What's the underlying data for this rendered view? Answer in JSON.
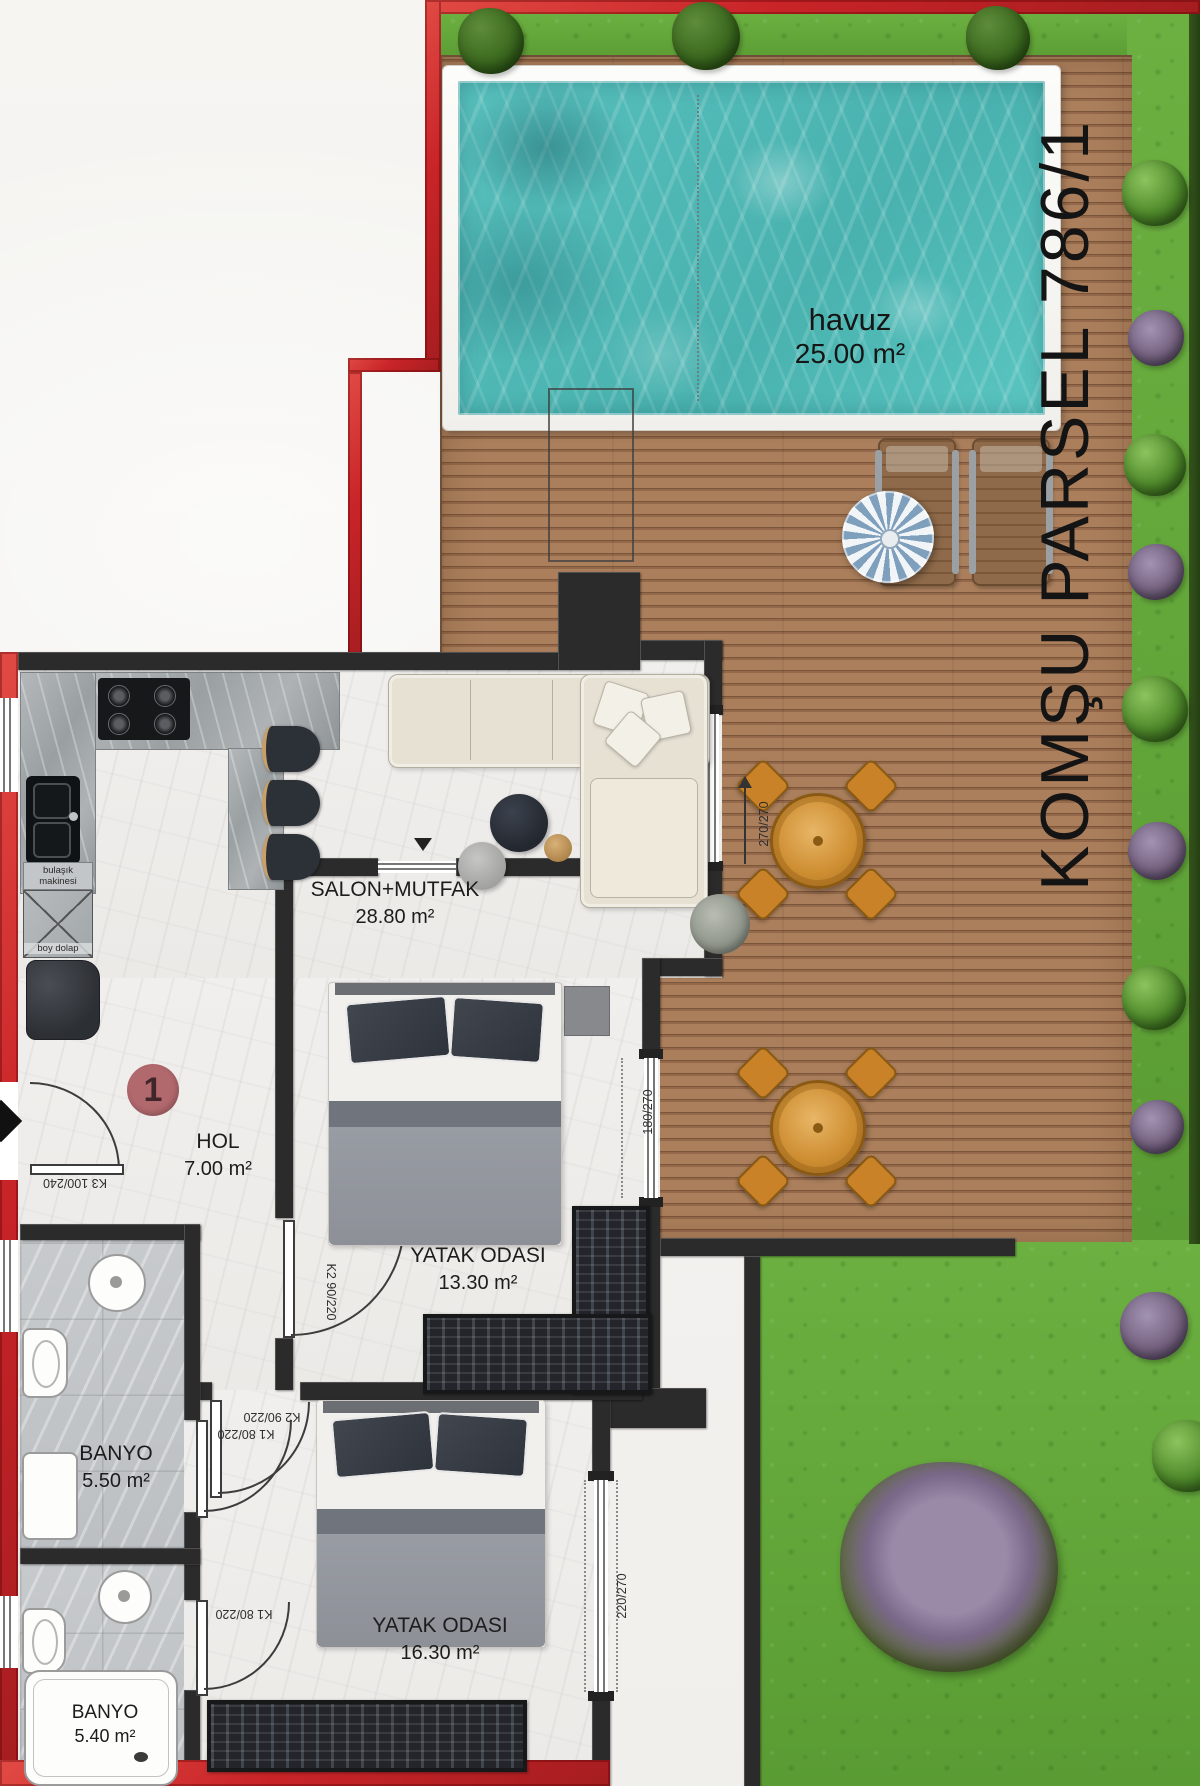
{
  "outdoor": {
    "pool": {
      "name": "havuz",
      "area": "25.00 m²"
    },
    "neighbor_parcel_label": "KOMŞU PARSEL 786/1"
  },
  "unit": {
    "number": "1"
  },
  "rooms": [
    {
      "id": "salon",
      "name": "SALON+MUTFAK",
      "area": "28.80 m²"
    },
    {
      "id": "hol",
      "name": "HOL",
      "area": "7.00 m²"
    },
    {
      "id": "bedroom1",
      "name": "YATAK ODASI",
      "area": "13.30 m²"
    },
    {
      "id": "bathroom1",
      "name": "BANYO",
      "area": "5.50 m²"
    },
    {
      "id": "bedroom2",
      "name": "YATAK ODASI",
      "area": "16.30 m²"
    },
    {
      "id": "bathroom2",
      "name": "BANYO",
      "area": "5.40 m²"
    }
  ],
  "kitchen": {
    "dishwasher_label": "bulaşık makinesi",
    "tall_cabinet_label": "boy dolap"
  },
  "doors": {
    "entrance": "K3 100/240",
    "bedroom1": "K2 90/220",
    "bedroom2": "K2 90/220",
    "bathroom1": "K1 80/220",
    "bathroom2": "K1 80/220"
  },
  "windows": {
    "salon": "270/270",
    "bedroom1": "180/270",
    "bedroom2": "220/270"
  },
  "colors": {
    "exterior_wall": "#c9282d",
    "interior_wall": "#2b2b2b",
    "pool_water": "#5ec3bf",
    "deck": "#a87c5c",
    "grass": "#65a83e",
    "badge": "#b26a6e"
  }
}
